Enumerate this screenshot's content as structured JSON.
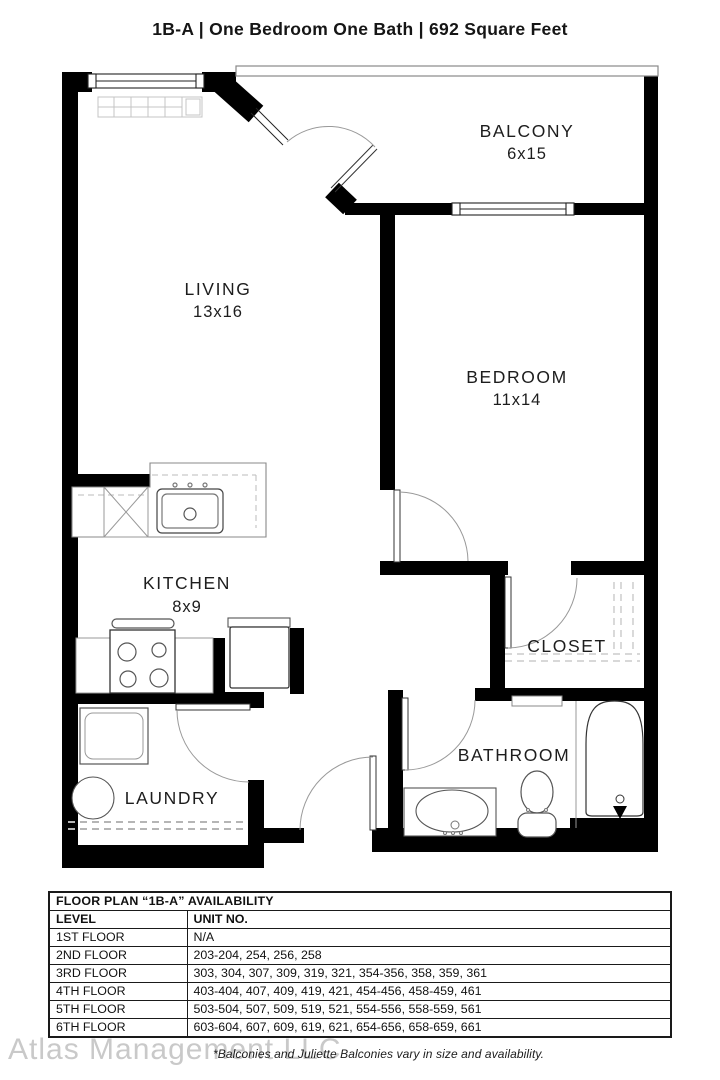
{
  "title": "1B-A | One Bedroom One Bath | 692 Square Feet",
  "floorplan": {
    "living": {
      "name": "LIVING",
      "dims": "13x16"
    },
    "balcony": {
      "name": "BALCONY",
      "dims": "6x15"
    },
    "bedroom": {
      "name": "BEDROOM",
      "dims": "11x14"
    },
    "kitchen": {
      "name": "KITCHEN",
      "dims": "8x9"
    },
    "closet": {
      "name": "CLOSET"
    },
    "bathroom": {
      "name": "BATHROOM"
    },
    "laundry": {
      "name": "LAUNDRY"
    }
  },
  "availability_table": {
    "title": "FLOOR PLAN “1B-A” AVAILABILITY",
    "columns": {
      "level": "LEVEL",
      "units": "UNIT NO."
    },
    "rows": [
      {
        "level": "1ST FLOOR",
        "units": "N/A"
      },
      {
        "level": "2ND FLOOR",
        "units": "203-204, 254, 256, 258"
      },
      {
        "level": "3RD FLOOR",
        "units": "303, 304, 307, 309, 319, 321, 354-356, 358, 359, 361"
      },
      {
        "level": "4TH FLOOR",
        "units": "403-404, 407, 409, 419, 421, 454-456, 458-459, 461"
      },
      {
        "level": "5TH FLOOR",
        "units": "503-504, 507, 509, 519, 521, 554-556, 558-559, 561"
      },
      {
        "level": "6TH FLOOR",
        "units": "603-604, 607, 609, 619, 621, 654-656, 658-659, 661"
      }
    ]
  },
  "footer": {
    "watermark": "Atlas Management LLC",
    "note": "*Balconies and Juliette Balconies vary in size and availability."
  },
  "colors": {
    "wall": "#000000",
    "fixture_line": "#555555",
    "light_line": "#aaaaaa",
    "watermark_gray": "#c9c9c9"
  }
}
